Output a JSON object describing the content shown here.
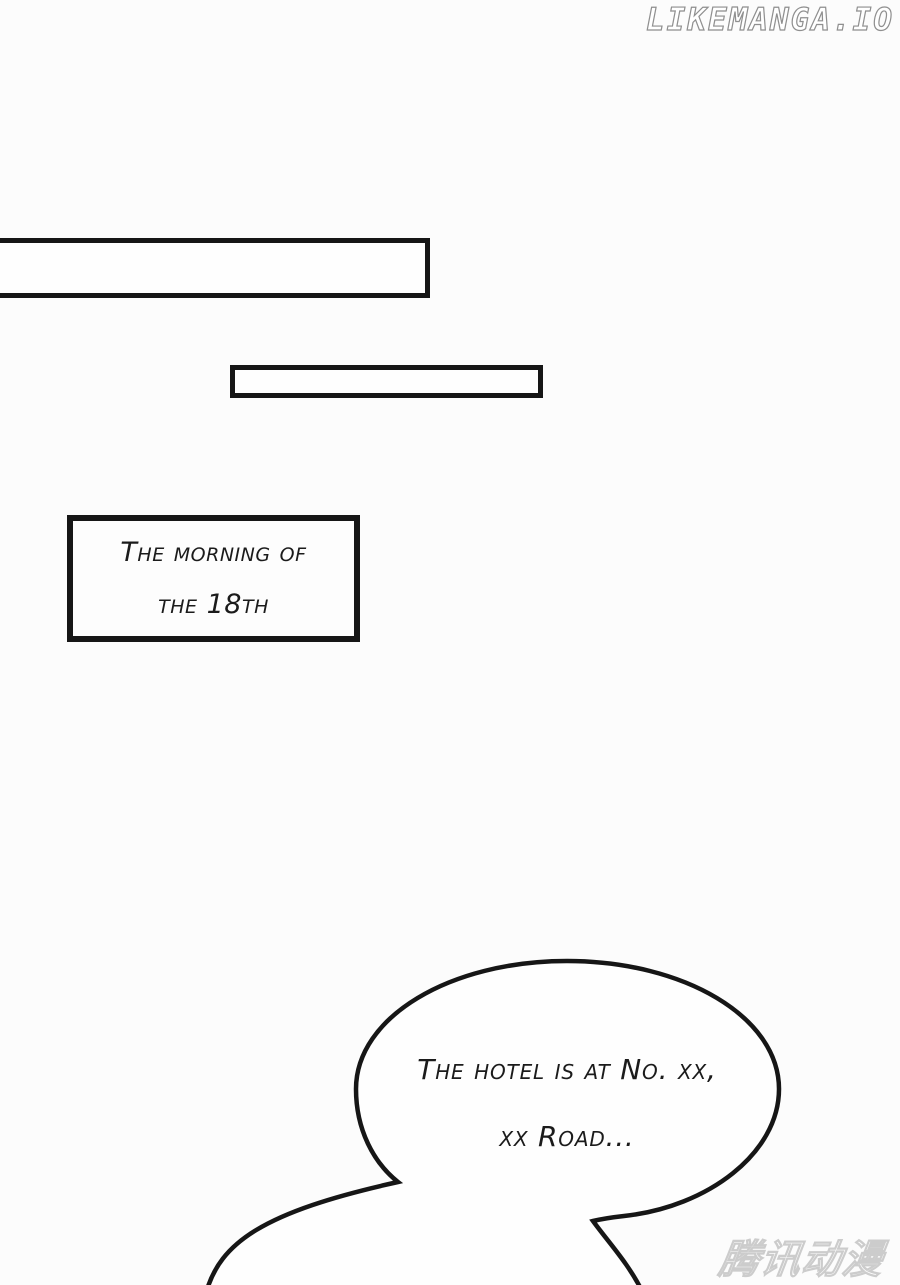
{
  "page": {
    "background": "#fcfcfc",
    "ink_color": "#161616"
  },
  "watermarks": {
    "site": "LIKEMANGA.IO",
    "publisher": "腾讯动漫"
  },
  "caption_box": {
    "line1": "The morning of",
    "line2": "the 18th"
  },
  "speech_bubble": {
    "line1": "The hotel is at No. xx,",
    "line2": "xx Road..."
  }
}
